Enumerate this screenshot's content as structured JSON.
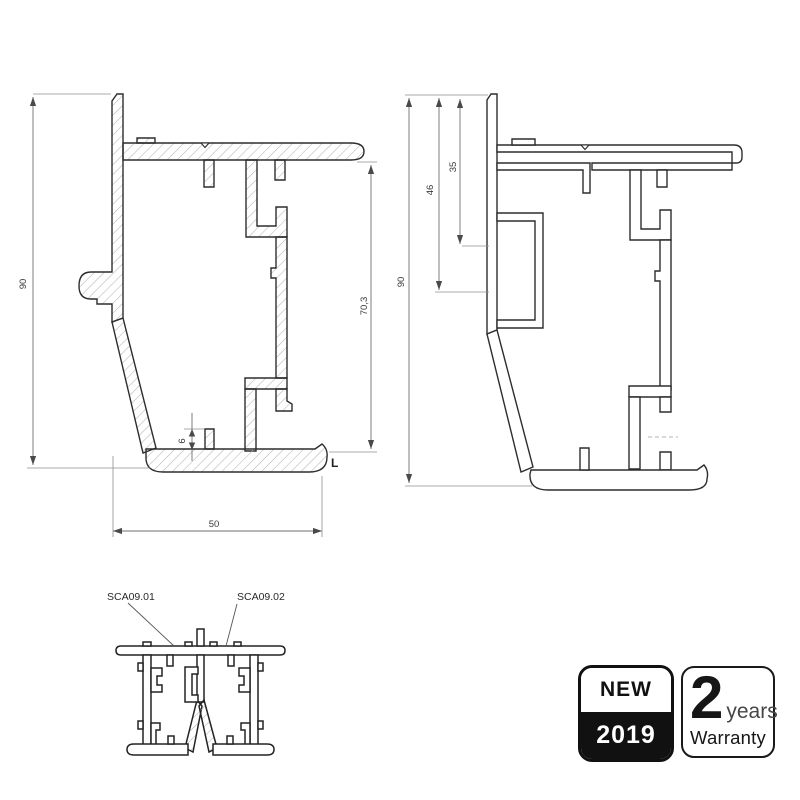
{
  "left_drawing": {
    "dims": {
      "overall_height": "90",
      "inner_height": "70,3",
      "foot_rib": "6",
      "overall_width": "50"
    },
    "corner_label": "L"
  },
  "right_drawing": {
    "dims": {
      "overall_height": "90",
      "channel_depth": "46",
      "top_offset": "35"
    }
  },
  "assembly_drawing": {
    "part_labels": {
      "left": "SCA09.01",
      "right": "SCA09.02"
    }
  },
  "badges": {
    "new": {
      "label": "NEW",
      "year": "2019"
    },
    "warranty": {
      "value": "2",
      "unit": "years",
      "caption": "Warranty"
    }
  },
  "colors": {
    "background": "#ffffff",
    "line": "#2d2d2d",
    "dimension": "#6f6f6f",
    "hatch": "#b3b3b3",
    "badge_dark": "#111111"
  }
}
